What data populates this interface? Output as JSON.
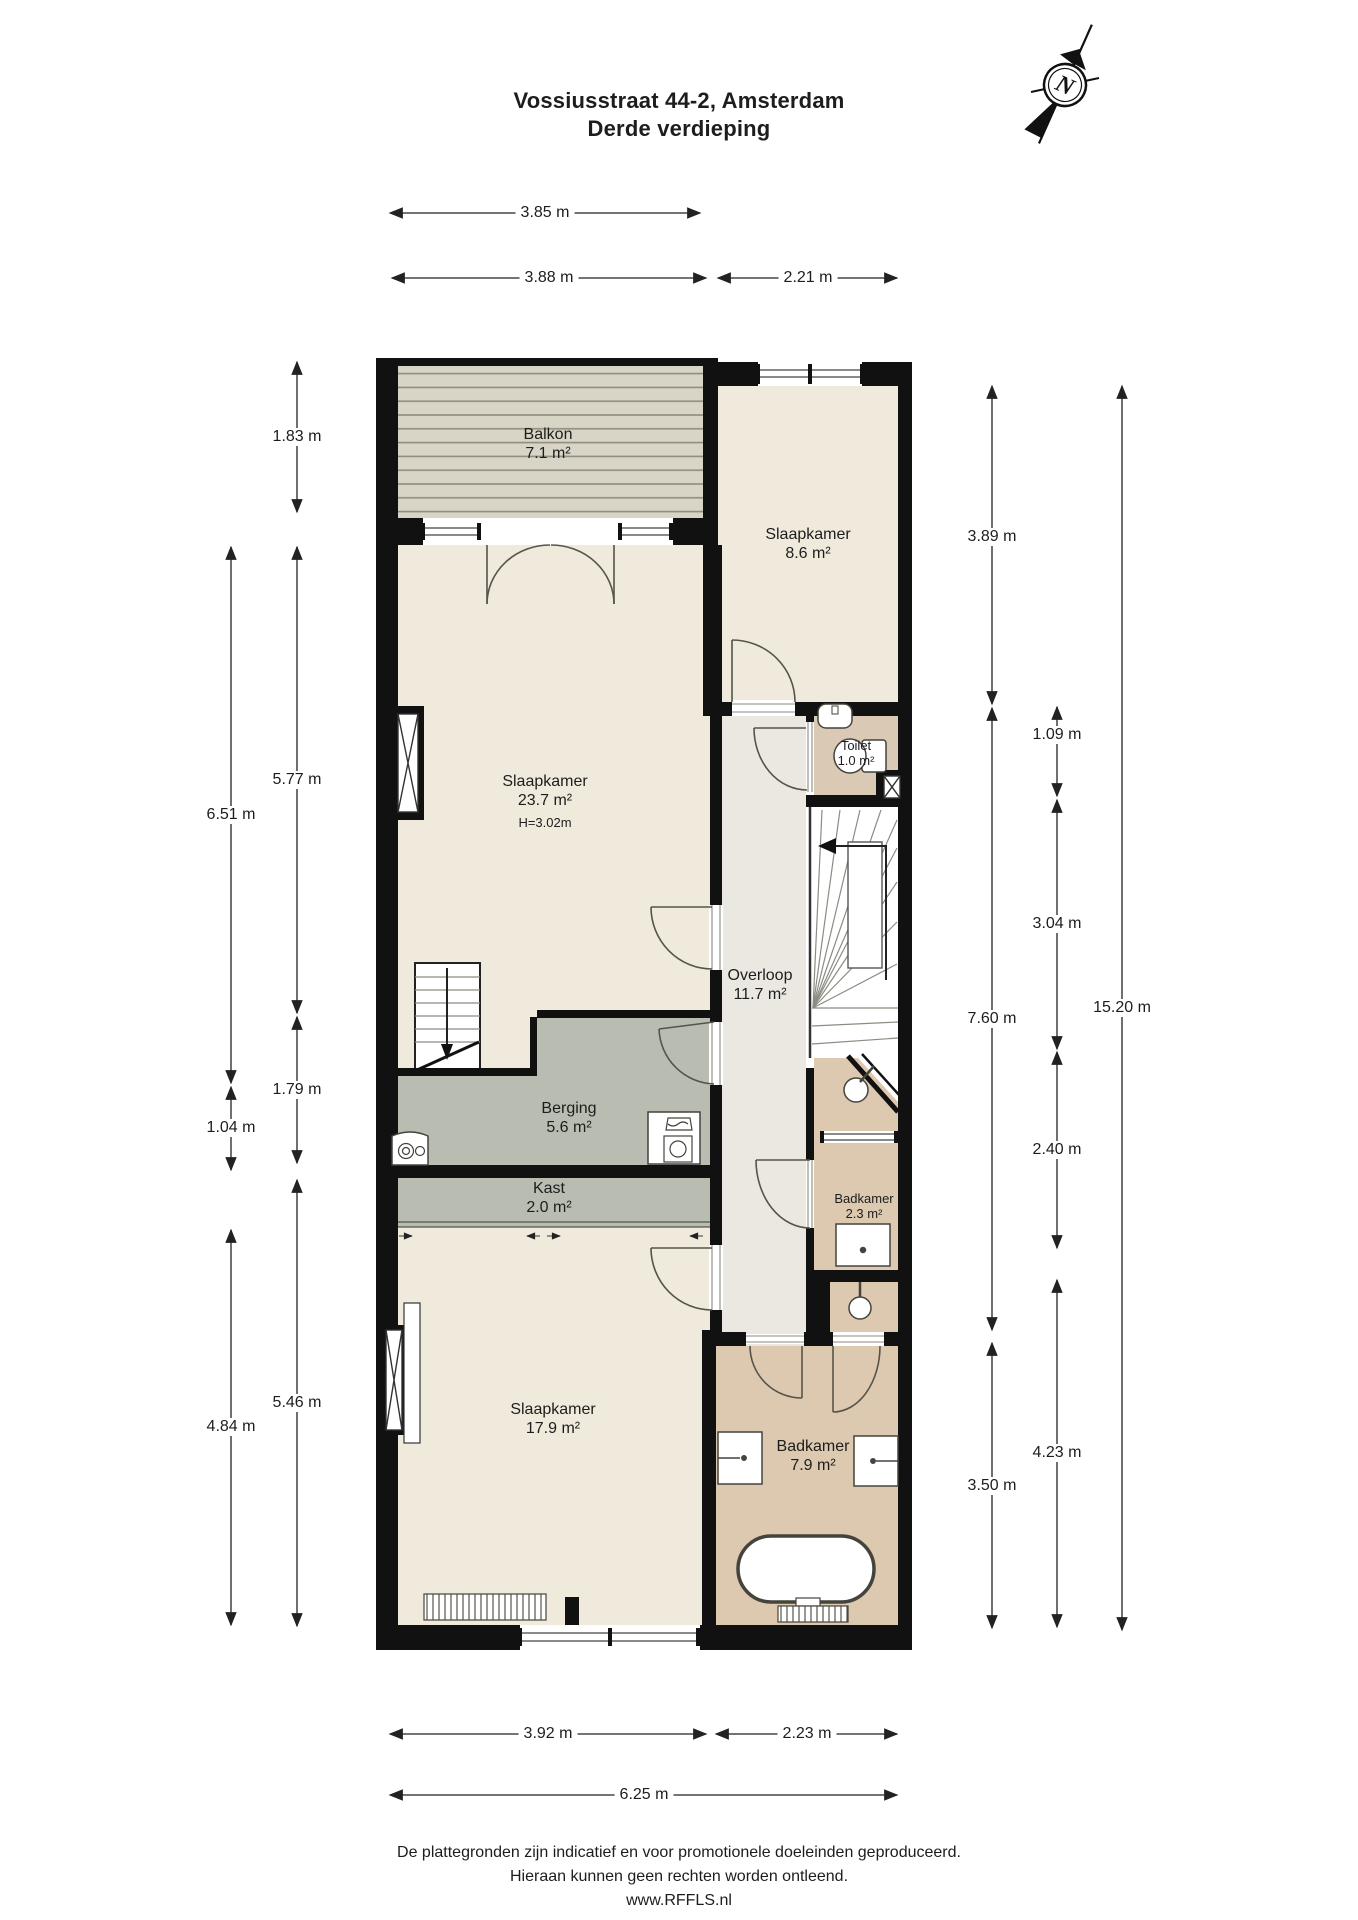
{
  "title": {
    "line1": "Vossiusstraat 44-2, Amsterdam",
    "line2": "Derde verdieping"
  },
  "compass": {
    "north_label": "N"
  },
  "rooms": {
    "balkon": {
      "name": "Balkon",
      "area": "7.1 m²"
    },
    "slaapkamer_boven": {
      "name": "Slaapkamer",
      "area": "8.6 m²"
    },
    "slaapkamer_groot": {
      "name": "Slaapkamer",
      "area": "23.7 m²",
      "height": "H=3.02m"
    },
    "toilet": {
      "name": "Toilet",
      "area": "1.0 m²"
    },
    "overloop": {
      "name": "Overloop",
      "area": "11.7 m²"
    },
    "berging": {
      "name": "Berging",
      "area": "5.6 m²"
    },
    "kast": {
      "name": "Kast",
      "area": "2.0 m²"
    },
    "slaapkamer_onder": {
      "name": "Slaapkamer",
      "area": "17.9 m²"
    },
    "badkamer_klein": {
      "name": "Badkamer",
      "area": "2.3 m²"
    },
    "badkamer_groot": {
      "name": "Badkamer",
      "area": "7.9 m²"
    }
  },
  "dims": {
    "top_balkon": "3.85 m",
    "top_links": "3.88 m",
    "top_rechts": "2.21 m",
    "links_balkon": "1.83 m",
    "links_slaapkamer": "5.77 m",
    "links_totaal_midden": "6.51 m",
    "links_berging": "1.79 m",
    "links_berging_buiten": "1.04 m",
    "links_slaapkamer_onder": "5.46 m",
    "links_onder_buiten": "4.84 m",
    "rechts_slaapkamer_boven": "3.89 m",
    "rechts_toilet": "1.09 m",
    "rechts_trap": "3.04 m",
    "rechts_overloop": "7.60 m",
    "rechts_badkamer_klein": "2.40 m",
    "rechts_badkamer_groot": "3.50 m",
    "rechts_onder": "4.23 m",
    "rechts_totaal": "15.20 m",
    "onder_links": "3.92 m",
    "onder_rechts": "2.23 m",
    "onder_totaal": "6.25 m"
  },
  "footer": {
    "line1": "De plattegronden zijn indicatief en voor promotionele doeleinden geproduceerd.",
    "line2": "Hieraan kunnen geen rechten worden ontleend.",
    "line3": "www.RFFLS.nl"
  }
}
